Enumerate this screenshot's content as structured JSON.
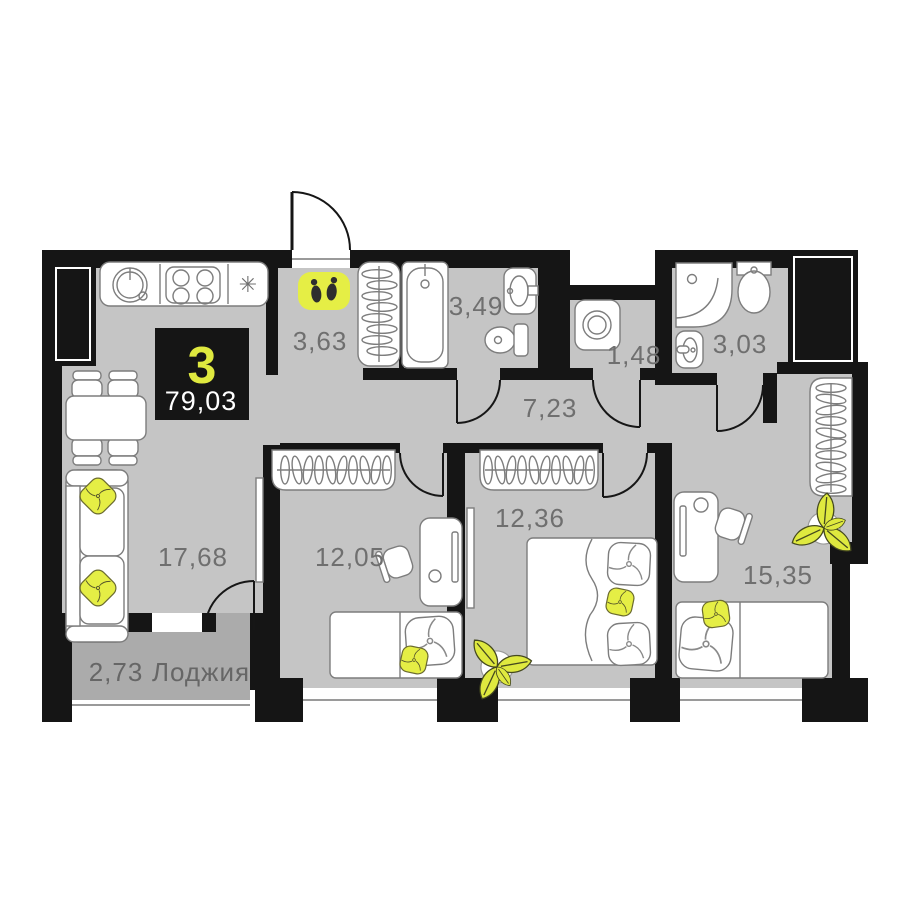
{
  "plan": {
    "badge": {
      "rooms": "3",
      "total_area": "79,03"
    },
    "rooms": {
      "living": {
        "label": "17,68"
      },
      "hall": {
        "label": "3,63"
      },
      "bathroom": {
        "label": "3,49"
      },
      "laundry": {
        "label": "1,48"
      },
      "shower_room": {
        "label": "3,03"
      },
      "corridor": {
        "label": "7,23"
      },
      "bedroom1": {
        "label": "12,05"
      },
      "bedroom2": {
        "label": "12,36"
      },
      "bedroom3": {
        "label": "15,35"
      },
      "loggia": {
        "area": "2,73",
        "name": "Лоджия"
      }
    },
    "icons": {
      "entrance": "footprints",
      "kitchen_star": "✳"
    },
    "colors": {
      "accent": "#e5ee45",
      "wall": "#151515",
      "floor": "#c5c5c5",
      "loggia_floor": "#ababab",
      "label_text": "#6f6f6f",
      "badge_bg": "#151515",
      "badge_number": "#dfe93f"
    }
  }
}
